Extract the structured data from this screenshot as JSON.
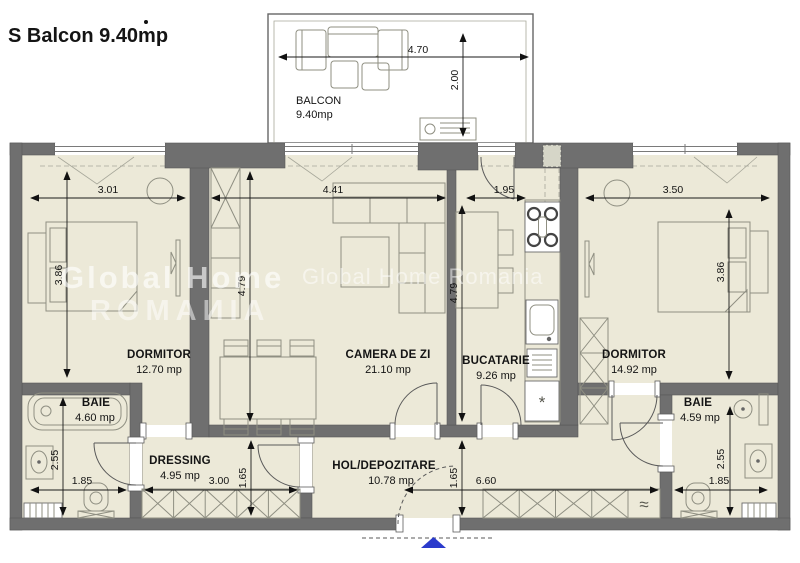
{
  "title": "S Balcon  9.40mp",
  "watermarks": {
    "primary_line1": "Global Home",
    "primary_line2": "ROMAИIA",
    "secondary": "Global Home Romania"
  },
  "rooms": [
    {
      "name": "BALCON",
      "area": "9.40mp"
    },
    {
      "name": "DORMITOR",
      "area": "12.70 mp"
    },
    {
      "name": "CAMERA DE ZI",
      "area": "21.10 mp"
    },
    {
      "name": "BUCATARIE",
      "area": "9.26 mp"
    },
    {
      "name": "DORMITOR",
      "area": "14.92 mp"
    },
    {
      "name": "BAIE",
      "area": "4.60 mp"
    },
    {
      "name": "DRESSING",
      "area": "4.95 mp"
    },
    {
      "name": "HOL/DEPOZITARE",
      "area": "10.78 mp"
    },
    {
      "name": "BAIE",
      "area": "4.59 mp"
    }
  ],
  "dimensions": {
    "balcon_width": "4.70",
    "balcon_depth": "2.00",
    "dormitor_left_width": "3.01",
    "dormitor_left_depth": "3.86",
    "camera_width": "4.41",
    "camera_depth": "4.79",
    "bucatarie_width": "1.95",
    "bucatarie_depth": "4.79",
    "dormitor_right_width": "3.50",
    "dormitor_right_depth": "3.86",
    "baie_left_depth": "2.55",
    "baie_left_width": "1.85",
    "dressing_width": "3.00",
    "dressing_depth": "1.65",
    "hol_depth": "1.65",
    "hol_width": "6.60",
    "baie_right_width": "1.85",
    "baie_right_depth": "2.55"
  },
  "symbols": {
    "washer": "≈",
    "freezer": "*"
  },
  "colors": {
    "floor": "#ece9d8",
    "wall": "#6f6f6f",
    "line": "#8f8f82",
    "entry_marker": "#2b3bcc"
  }
}
